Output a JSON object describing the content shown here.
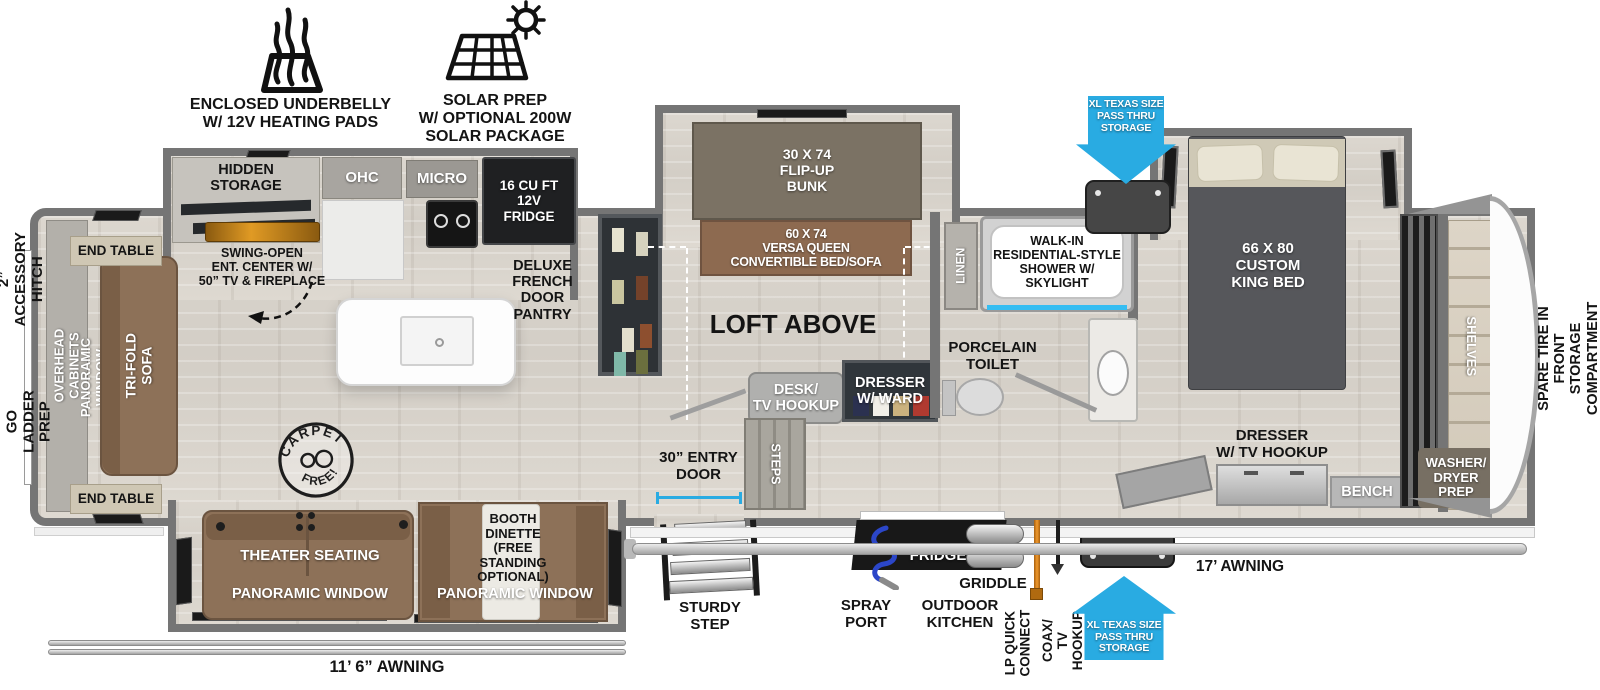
{
  "icons": {
    "underbelly": "ENCLOSED UNDERBELLY\nW/ 12V HEATING PADS",
    "solar": "SOLAR PREP\nW/ OPTIONAL 200W\nSOLAR PACKAGE"
  },
  "exterior": {
    "hitch": "2” ACCESSORY\nHITCH",
    "ladder_prep": "ON-THE-GO\nLADDER PREP",
    "spare_tire": "SPARE TIRE IN FRONT\nSTORAGE COMPARTMENT",
    "awning_door_side": "17’ AWNING",
    "awning_off_door": "11’ 6” AWNING",
    "pass_thru": "XL TEXAS SIZE\nPASS THRU\nSTORAGE",
    "entry_door": "30” ENTRY\nDOOR",
    "sturdy_step": "STURDY\nSTEP",
    "spray_port": "SPRAY\nPORT",
    "outdoor_kitchen": "OUTDOOR\nKITCHEN",
    "outdoor_fridge": "FRIDGE",
    "griddle": "GRIDDLE",
    "lp_quick_connect": "LP QUICK\nCONNECT",
    "coax": "COAX/\nTV HOOKUP"
  },
  "living": {
    "end_table": "END TABLE",
    "overhead_cabinets": "OVERHEAD CABINETS",
    "panoramic_window": "PANORAMIC WINDOW",
    "tri_fold_sofa": "TRI-FOLD SOFA",
    "theater_seating": "THEATER SEATING",
    "booth_dinette": "BOOTH\nDINETTE\n(FREE\nSTANDING\nOPTIONAL)",
    "carpet_stamp_top": "CARPET",
    "carpet_stamp_bottom": "FREE!"
  },
  "kitchen": {
    "hidden_storage": "HIDDEN\nSTORAGE",
    "ohc": "OHC",
    "micro": "MICRO",
    "fridge": "16 CU FT\n12V\nFRIDGE",
    "ent_center": "SWING-OPEN\nENT. CENTER W/\n50” TV & FIREPLACE",
    "pantry": "DELUXE\nFRENCH\nDOOR\nPANTRY"
  },
  "bunk": {
    "flip_up_bunk": "30 X 74\nFLIP-UP\nBUNK",
    "versa_queen": "60 X 74\nVERSA QUEEN\nCONVERTIBLE BED/SOFA",
    "loft_above": "LOFT ABOVE",
    "desk": "DESK/\nTV HOOKUP",
    "dresser_ward": "DRESSER\nW/ WARD",
    "steps": "STEPS"
  },
  "bath": {
    "linen": "LINEN",
    "shower": "WALK-IN\nRESIDENTIAL-STYLE\nSHOWER W/\nSKYLIGHT",
    "toilet": "PORCELAIN\nTOILET"
  },
  "bedroom": {
    "king_bed": "66 X 80\nCUSTOM\nKING BED",
    "dresser": "DRESSER\nW/ TV HOOKUP",
    "bench": "BENCH"
  },
  "front": {
    "shelves": "SHELVES",
    "washer_dryer": "WASHER/\nDRYER\nPREP"
  },
  "colors": {
    "accent_blue": "#29abe2",
    "furniture_brown": "#8d7158",
    "floor": "#d8d3cb",
    "wall": "#757575",
    "shower_accent": "#35bdf2",
    "lp_hose": "#e0821a",
    "spray_hose": "#2b46c8"
  }
}
